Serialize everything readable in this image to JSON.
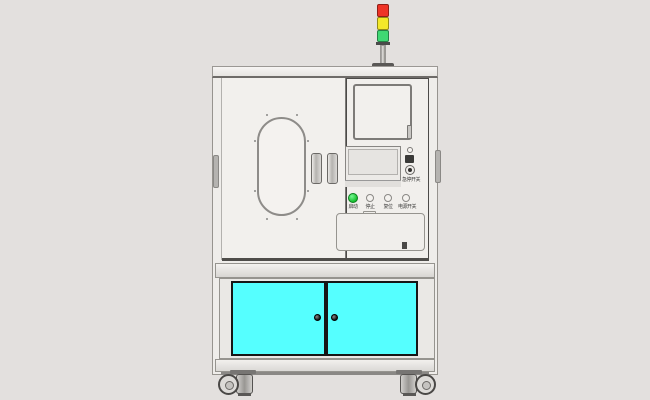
{
  "scene": {
    "title": "equipment-cabinet-front-view",
    "background_color": "#e3e0de",
    "cabinet_face_color": "#f1efec"
  },
  "tower_light": {
    "segments": [
      {
        "name": "red-lamp",
        "color": "#ee3326"
      },
      {
        "name": "yellow-lamp",
        "color": "#f3e829"
      },
      {
        "name": "green-lamp",
        "color": "#3fd873"
      }
    ]
  },
  "lower_cabinet": {
    "door_color": "#55ffff",
    "door_border_color": "#161616"
  },
  "control_panel": {
    "green_button_color": "#17c02f",
    "buttons": [
      {
        "label": "启动"
      },
      {
        "label": "停止"
      },
      {
        "label": "复位"
      },
      {
        "label": "电源开关"
      }
    ],
    "estop_label": "急停开关"
  }
}
